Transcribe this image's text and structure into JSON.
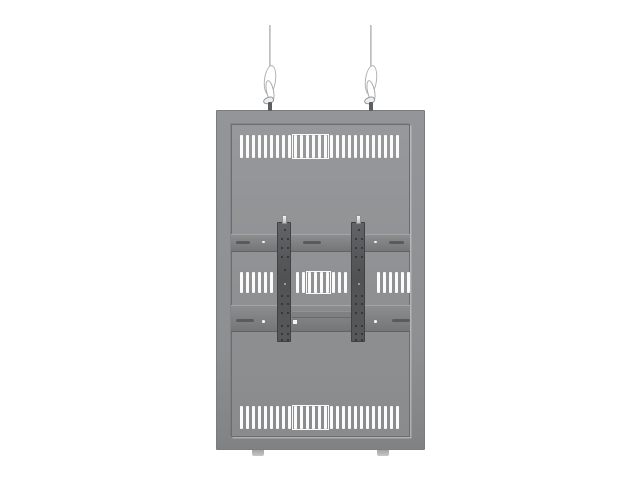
{
  "scene": {
    "description": "Product photo: gray hanging enclosure / back-to-back display mount suspended from two wire cables, with ventilation slot rows and a dual-arm VESA mounting bracket",
    "background_label": "plain white studio background"
  },
  "colors": {
    "bg": "#ffffff",
    "frame": "#8f9193",
    "panel": "#909294",
    "rail": "#7b7d7f",
    "bracket": "#54565a",
    "slot": "#fbfbfc",
    "cable": "#c6c8ca"
  },
  "suspension": {
    "cable_count": 2,
    "parts": [
      "wire-cable",
      "twisted-wire-loop",
      "cable-clamp",
      "attachment-pin"
    ]
  },
  "vents": {
    "slot_pitch": 6,
    "slot_width": 3.2,
    "rows": [
      {
        "name": "top",
        "y": 135,
        "height": 23,
        "groups": [
          {
            "x": 240,
            "count": 27,
            "ladder": {
              "from": 9,
              "to": 14
            }
          }
        ]
      },
      {
        "name": "middle",
        "y": 272,
        "height": 21,
        "groups": [
          {
            "x": 240,
            "count": 6
          },
          {
            "x": 296,
            "count": 9,
            "ladder": {
              "from": 2,
              "to": 5
            }
          },
          {
            "x": 377,
            "count": 6
          }
        ]
      },
      {
        "name": "bottom",
        "y": 406,
        "height": 23,
        "groups": [
          {
            "x": 240,
            "count": 27,
            "ladder": {
              "from": 9,
              "to": 14
            }
          }
        ]
      }
    ]
  },
  "rails": {
    "upper": {
      "dashes": [
        {
          "x": 5,
          "y": 6,
          "w": 14
        },
        {
          "x": 72,
          "y": 6,
          "w": 18
        },
        {
          "x": 158,
          "y": 6,
          "w": 15
        }
      ],
      "screws": [
        {
          "x": 31,
          "y": 5.5
        },
        {
          "x": 143,
          "y": 5.5
        }
      ]
    },
    "lower": {
      "dashes": [
        {
          "x": 5,
          "y": 13,
          "w": 18
        },
        {
          "x": 161,
          "y": 13,
          "w": 18
        }
      ],
      "screws": [
        {
          "x": 31,
          "y": 14
        },
        {
          "x": 143,
          "y": 14
        }
      ]
    }
  },
  "brackets": {
    "count": 2,
    "hole_rows": [
      {
        "y": 6,
        "type": "single"
      },
      {
        "y": 15,
        "type": "pair"
      },
      {
        "y": 24,
        "type": "pair"
      },
      {
        "y": 33,
        "type": "pair"
      },
      {
        "y": 46,
        "type": "single"
      },
      {
        "y": 60,
        "type": "light"
      },
      {
        "y": 72,
        "type": "pair"
      },
      {
        "y": 80,
        "type": "pair"
      },
      {
        "y": 89,
        "type": "pair"
      },
      {
        "y": 102,
        "type": "pair"
      },
      {
        "y": 110,
        "type": "pair"
      },
      {
        "y": 116,
        "type": "pair"
      }
    ],
    "pair_offsets": [
      3,
      8.5
    ],
    "single_offset": 5.5
  }
}
